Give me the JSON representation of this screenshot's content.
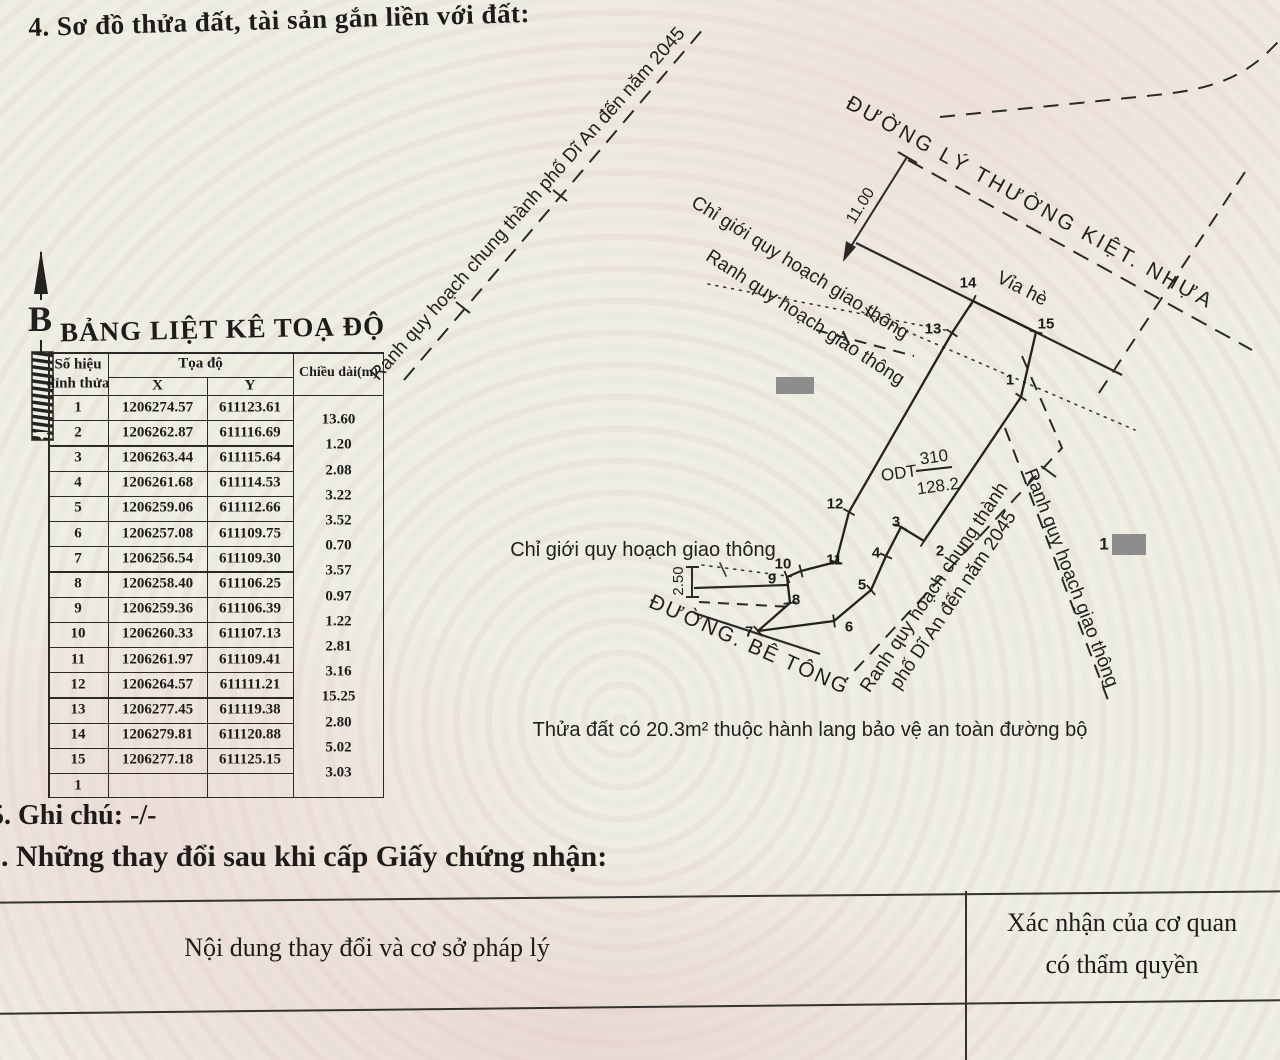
{
  "page": {
    "section4_title": "4. Sơ đồ thửa đất, tài sản gắn liền với đất:",
    "section5_title": "5. Ghi chú: -/-",
    "section6_title": "6. Những thay đổi sau khi cấp Giấy chứng nhận:"
  },
  "coord_table": {
    "title": "BẢNG LIỆT KÊ TOẠ ĐỘ",
    "headers": {
      "point_line1": "Số hiệu",
      "point_line2": "đỉnh thửa",
      "coords": "Tọa độ",
      "x": "X",
      "y": "Y",
      "length": "Chiều dài(m)"
    },
    "rows": [
      {
        "id": "1",
        "x": "1206274.57",
        "y": "611123.61"
      },
      {
        "id": "2",
        "x": "1206262.87",
        "y": "611116.69"
      },
      {
        "id": "3",
        "x": "1206263.44",
        "y": "611115.64"
      },
      {
        "id": "4",
        "x": "1206261.68",
        "y": "611114.53"
      },
      {
        "id": "5",
        "x": "1206259.06",
        "y": "611112.66"
      },
      {
        "id": "6",
        "x": "1206257.08",
        "y": "611109.75"
      },
      {
        "id": "7",
        "x": "1206256.54",
        "y": "611109.30"
      },
      {
        "id": "8",
        "x": "1206258.40",
        "y": "611106.25"
      },
      {
        "id": "9",
        "x": "1206259.36",
        "y": "611106.39"
      },
      {
        "id": "10",
        "x": "1206260.33",
        "y": "611107.13"
      },
      {
        "id": "11",
        "x": "1206261.97",
        "y": "611109.41"
      },
      {
        "id": "12",
        "x": "1206264.57",
        "y": "611111.21"
      },
      {
        "id": "13",
        "x": "1206277.45",
        "y": "611119.38"
      },
      {
        "id": "14",
        "x": "1206279.81",
        "y": "611120.88"
      },
      {
        "id": "15",
        "x": "1206277.18",
        "y": "611125.15"
      }
    ],
    "closing_row_id": "1",
    "lengths": [
      "13.60",
      "1.20",
      "2.08",
      "3.22",
      "3.52",
      "0.70",
      "3.57",
      "0.97",
      "1.22",
      "2.81",
      "3.16",
      "15.25",
      "2.80",
      "5.02",
      "3.03"
    ]
  },
  "map": {
    "north_label": "B",
    "labels": {
      "ranh_chung_topleft": "Ranh quy hoạch chung thành phố Dĩ An đến năm 2045",
      "duong_ly": "ĐƯỜNG LÝ THƯỜNG KIỆT. NHỰA",
      "via_he": "Vỉa hè",
      "dim_11": "11.00",
      "chi_gioi_diag": "Chỉ giới quy hoạch giao thông",
      "ranh_giao_diag": "Ranh quy hoạch giao thông",
      "chi_gioi_left": "Chỉ giới quy hoạch giao thông",
      "dim_250": "2.50",
      "duong_be_tong": "ĐƯỜNG. BÊ TÔNG",
      "ranh_chung_right": "Ranh quy hoạch chung thành\nphố Dĩ An đến năm 2045",
      "ranh_giao_right": "Ranh quy hoạch giao thông",
      "odt": "ODT",
      "parcel_number": "310",
      "parcel_area": "128.2",
      "redact_label": "1",
      "note": "Thửa đất có 20.3m² thuộc hành lang bảo vệ an toàn đường bộ"
    },
    "vertices": [
      "1",
      "2",
      "3",
      "4",
      "5",
      "6",
      "7",
      "8",
      "9",
      "10",
      "11",
      "12",
      "13",
      "14",
      "15"
    ]
  },
  "changes_table": {
    "left_header": "Nội dung thay đổi và cơ sở pháp lý",
    "right_header_line1": "Xác nhận của cơ quan",
    "right_header_line2": "có thẩm quyền"
  }
}
